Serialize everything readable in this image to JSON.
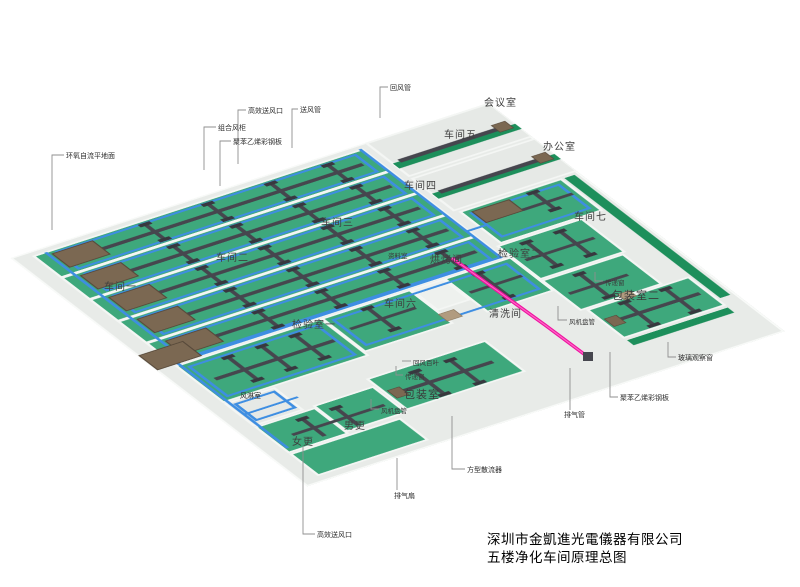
{
  "title_block": {
    "company": "深圳市金凱進光電儀器有限公司",
    "drawing": "五楼净化车间原理总图"
  },
  "labels": {
    "floor_coating": "环氧自流平地面",
    "ahu_unit": "组合风柜",
    "panel_top": "聚苯乙烯彩钢板",
    "hepa_top": "高效送风口",
    "supply_duct": "送风管",
    "return_duct": "回风管",
    "meeting_room": "会议室",
    "office": "办公室",
    "ws1": "车间一",
    "ws2": "车间二",
    "ws3": "车间三",
    "ws4": "车间四",
    "ws5": "车间五",
    "ws6": "车间六",
    "ws7": "车间七",
    "qc1": "检验室一",
    "qc2": "检验室二",
    "bake_room": "烘烤间",
    "clean_room": "清洗间",
    "data_room": "资料室",
    "pack1": "包装室一",
    "pack2": "包装室二",
    "air_shower": "风淋室",
    "women_change": "女更",
    "men_change": "男更",
    "pass_window_right": "传递窗",
    "pass_window_center": "传递窗",
    "fan_coil_right": "风机盘管",
    "fan_coil_center": "风机盘管",
    "glass_window": "玻璃观察窗",
    "panel_right": "聚苯乙烯彩钢板",
    "exhaust_pipe": "排气管",
    "return_louver": "回风百叶",
    "square_diffuser": "方型散流器",
    "exhaust_fan": "排气扇",
    "hepa_bottom": "高效送风口"
  },
  "colors": {
    "floor_green": "#3ea87c",
    "walkway_green": "#1d8f5b",
    "slab_gray": "#e8ebe8",
    "wall_white": "#f4f6f4",
    "duct_blue": "#3e8ee2",
    "duct_dark": "#46464e",
    "ahu_brown": "#7b6852",
    "exhaust_pink": "#ee12a0",
    "label_text": "#2e2e2e"
  }
}
